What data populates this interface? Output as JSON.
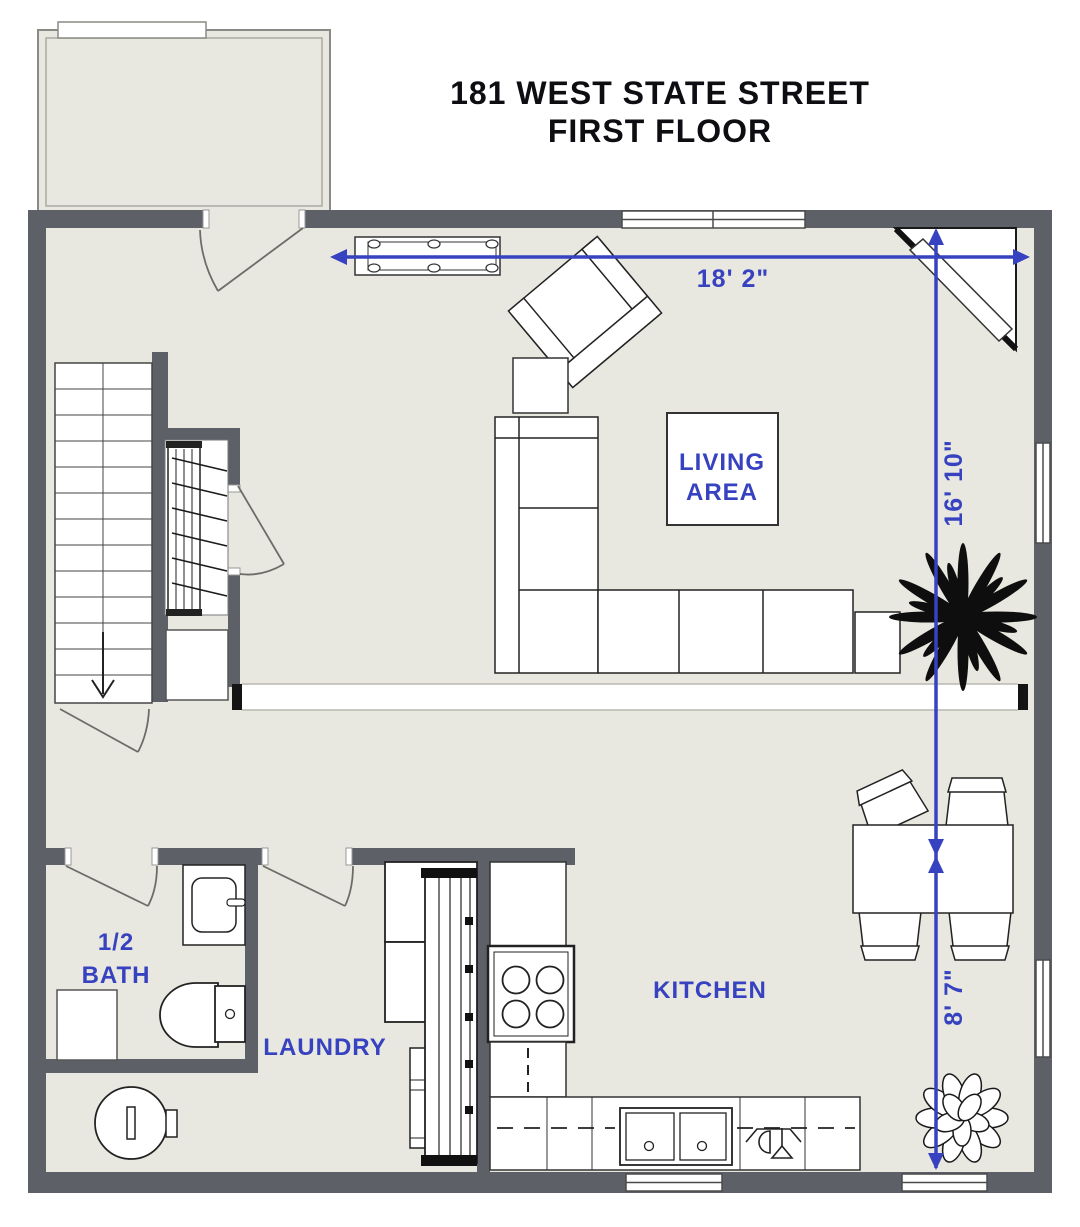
{
  "title": {
    "line1": "181 WEST STATE STREET",
    "line2": "FIRST FLOOR"
  },
  "rooms": {
    "living_line1": "LIVING",
    "living_line2": "AREA",
    "kitchen": "KITCHEN",
    "laundry": "LAUNDRY",
    "bath_line1": "1/2",
    "bath_line2": "BATH"
  },
  "dimensions": {
    "overall_width": "18' 2\"",
    "living_depth": "16' 10\"",
    "kitchen_depth": "8' 7\""
  },
  "colors": {
    "dimension_blue": "#3742c0",
    "label_blue": "#3742c0",
    "wall_gray": "#5d6067",
    "floor_beige": "#e9e8e0"
  }
}
